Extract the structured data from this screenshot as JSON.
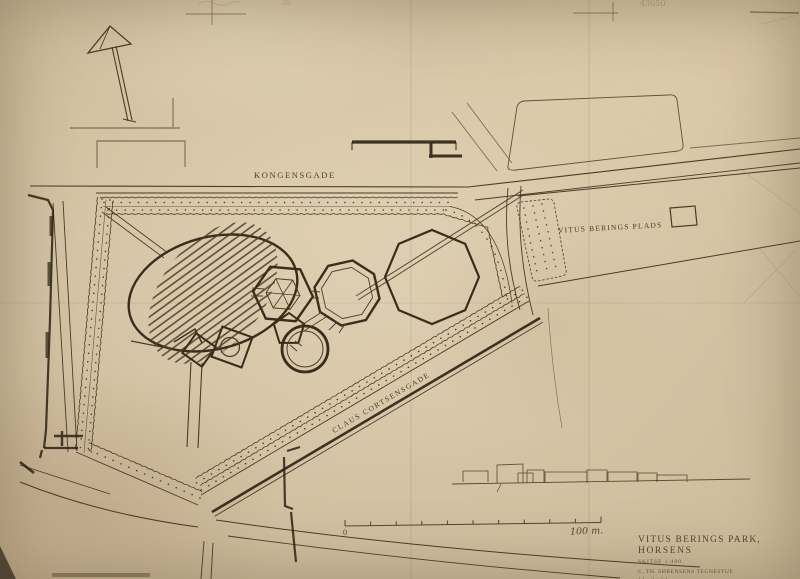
{
  "drawing": {
    "streets": {
      "kongensgade": "KONGENSGADE",
      "claus_cortsensgade": "CLAUS CORTSENSGADE"
    },
    "places": {
      "vitus_berings_plads": "VITUS BERINGS PLADS"
    },
    "scale_bar": {
      "start_label": "0",
      "end_label": "100 m."
    },
    "title_block": {
      "title_line1": "VITUS BERINGS PARK,",
      "title_line2": "HORSENS",
      "subtitle": "SKITSE  1:400.",
      "office": "C. TH. SØRENSENS TEGNESTUE",
      "date": "14 - 2 - 54."
    },
    "pencil_annotations": {
      "number_top_right": "43050",
      "number_top_left": "35"
    },
    "colors": {
      "paper": "#d7c6a8",
      "ink": "#4c3c27",
      "ink_dark": "#2c2114",
      "pencil": "#8f7d64"
    }
  }
}
